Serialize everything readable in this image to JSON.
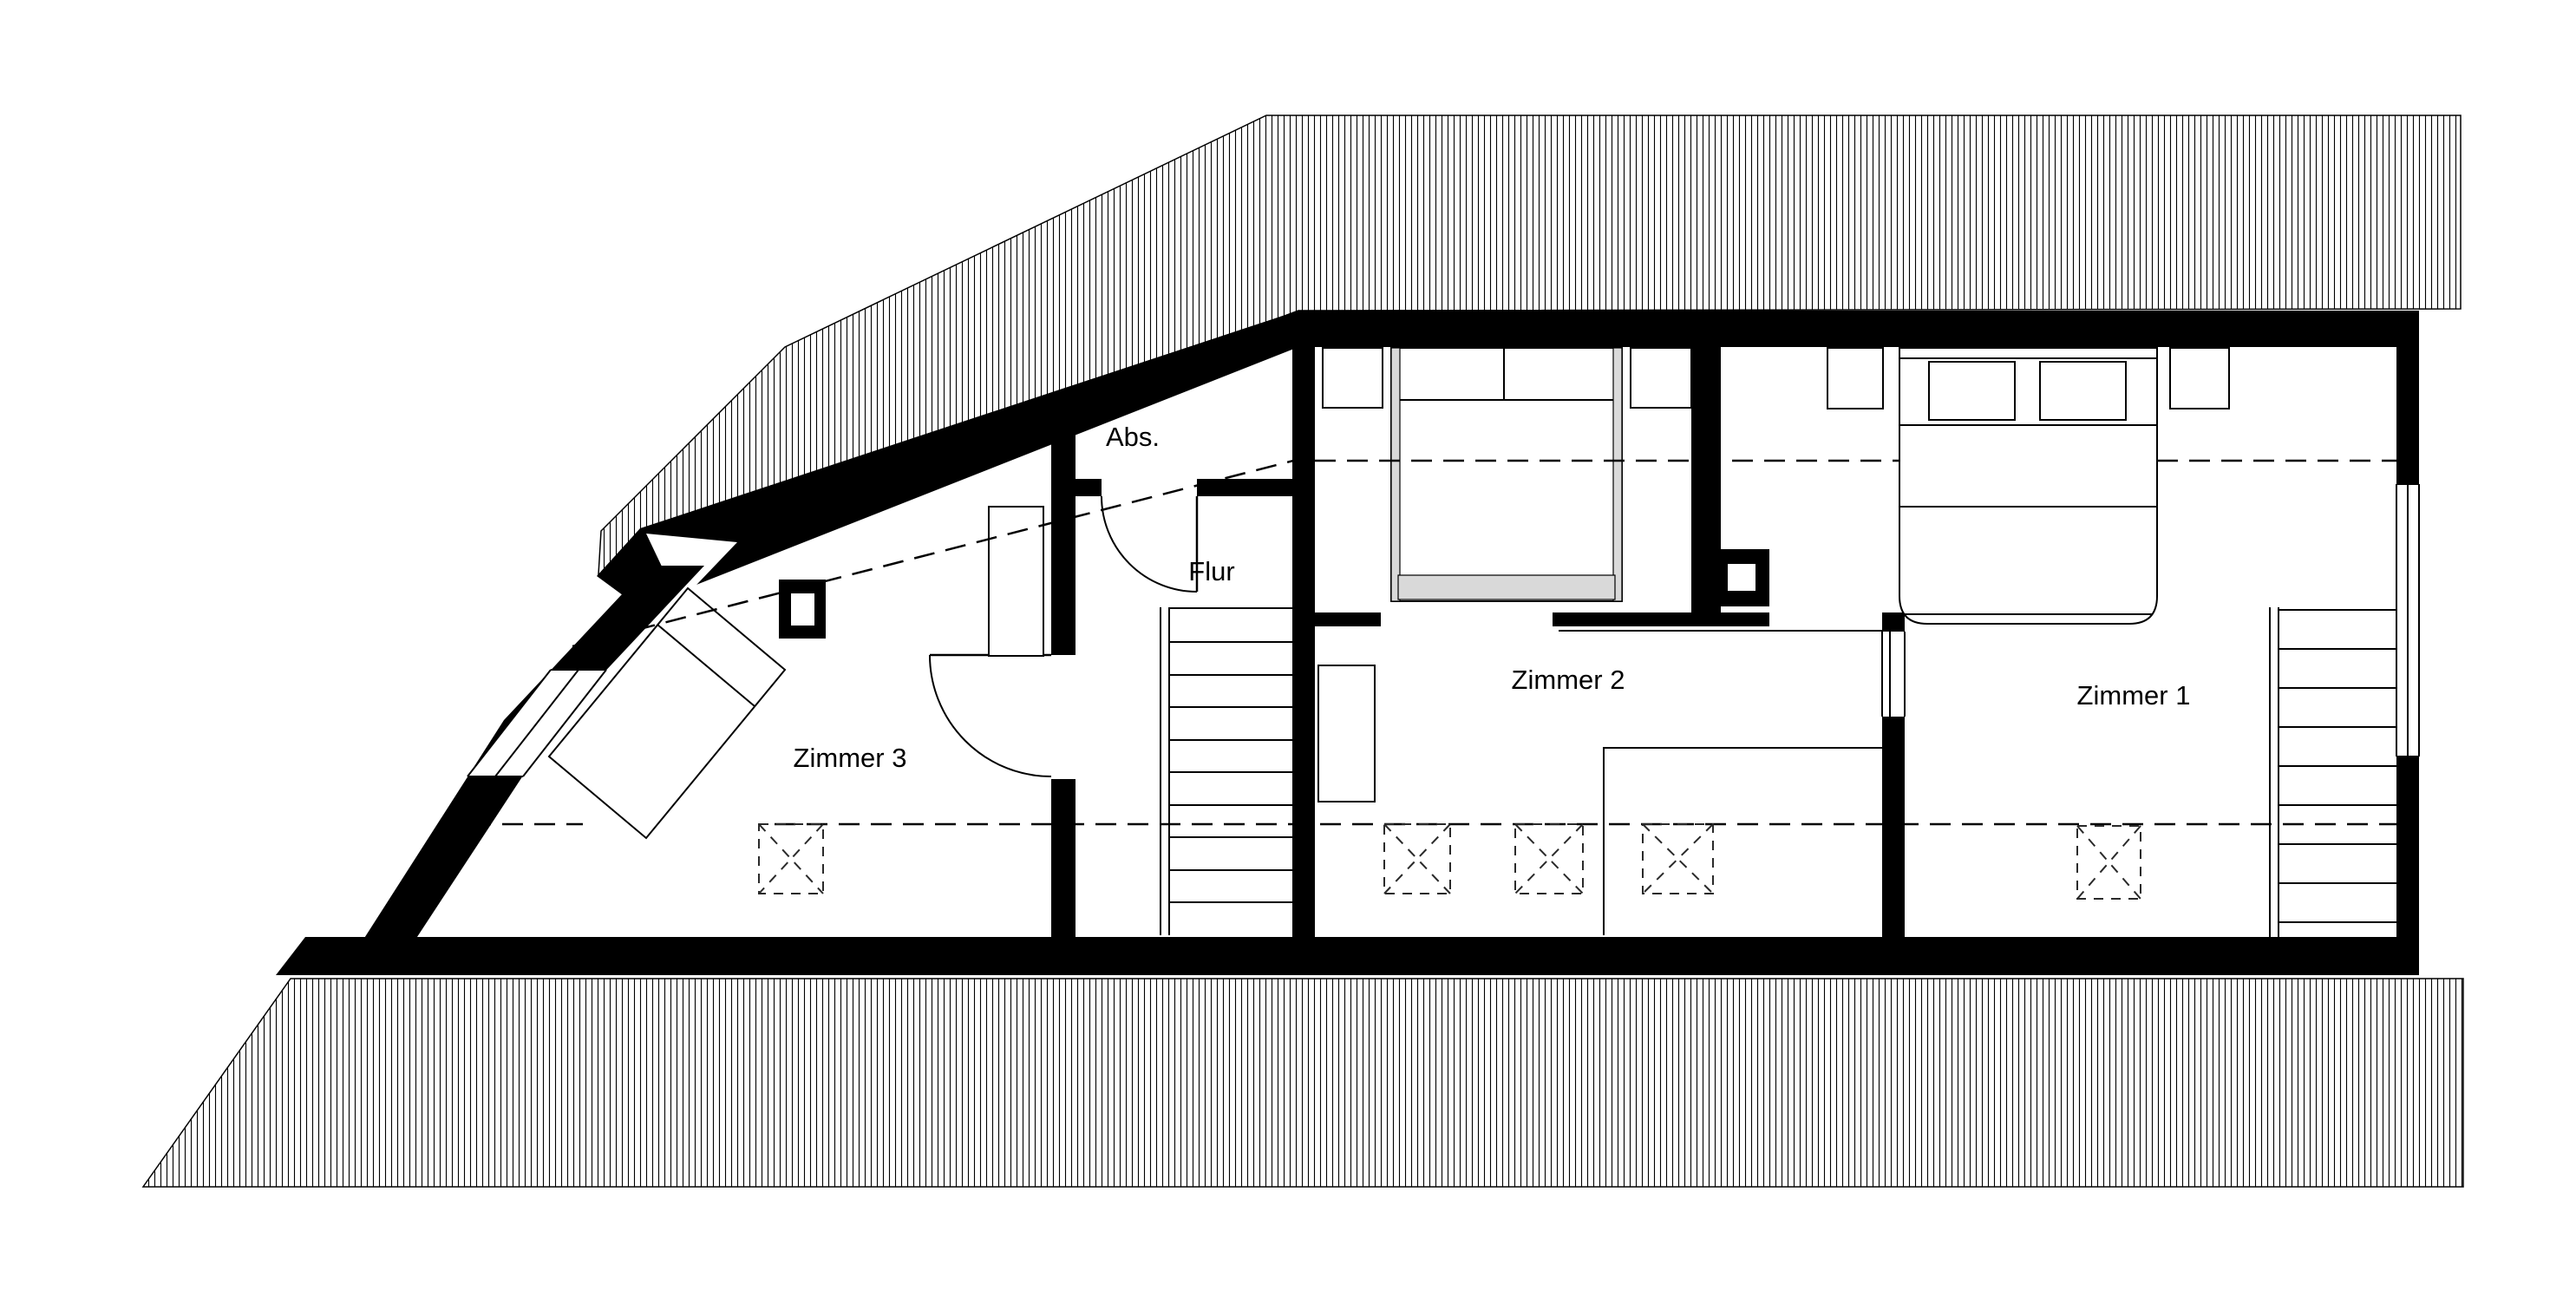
{
  "drawing": {
    "type": "floor-plan",
    "language": "de",
    "background_color": "#ffffff",
    "ink_color": "#000000",
    "furniture_fill_color": "#d9d9d9",
    "hatch_style": "thin-vertical-lines"
  },
  "rooms": [
    {
      "id": "zimmer1",
      "label": "Zimmer 1"
    },
    {
      "id": "zimmer2",
      "label": "Zimmer 2"
    },
    {
      "id": "zimmer3",
      "label": "Zimmer 3"
    },
    {
      "id": "flur",
      "label": "Flur"
    },
    {
      "id": "abs",
      "label": "Abs."
    }
  ],
  "symbols": {
    "skylight_count": 5,
    "chimney_count": 2,
    "staircase_count": 2,
    "door_swing_count": 2,
    "dashed_lines_meaning": "knee-wall / headroom lines"
  }
}
